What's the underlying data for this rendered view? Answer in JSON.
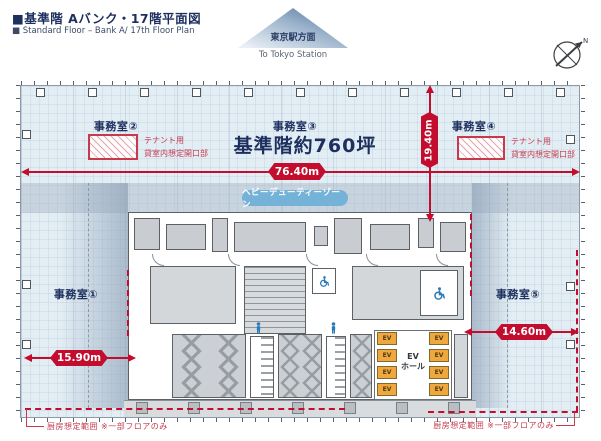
{
  "header": {
    "title_jp": "■基準階 Aバンク・17階平面図",
    "title_en": "■ Standard Floor – Bank A/ 17th Floor Plan"
  },
  "direction": {
    "jp": "東京駅方面",
    "en": "To Tokyo Station"
  },
  "compass": {
    "label": "N"
  },
  "plan": {
    "offices": [
      "事務室①",
      "事務室②",
      "事務室③",
      "事務室④",
      "事務室⑤"
    ],
    "area_label": "基準階約760坪",
    "heavy_duty_zone": "ヘビーデューティーゾーン",
    "tenant_note": {
      "line1": "テナント用",
      "line2": "貸室内想定開口部"
    },
    "kitchen_note": "厨房想定範囲 ※一部フロアのみ",
    "ev_label": "EV",
    "ev_hall": {
      "line1": "EV",
      "line2": "ホール"
    }
  },
  "dimensions": {
    "width": "76.40m",
    "depth": "19.40m",
    "left_span": "15.90m",
    "right_span": "14.60m"
  },
  "colors": {
    "accent_red": "#c30d2e",
    "navy": "#1c2f5e",
    "heavy_duty_pill": "#74b2d8",
    "ev_orange": "#f0a73e",
    "floor_blue": "#e3edf4"
  }
}
